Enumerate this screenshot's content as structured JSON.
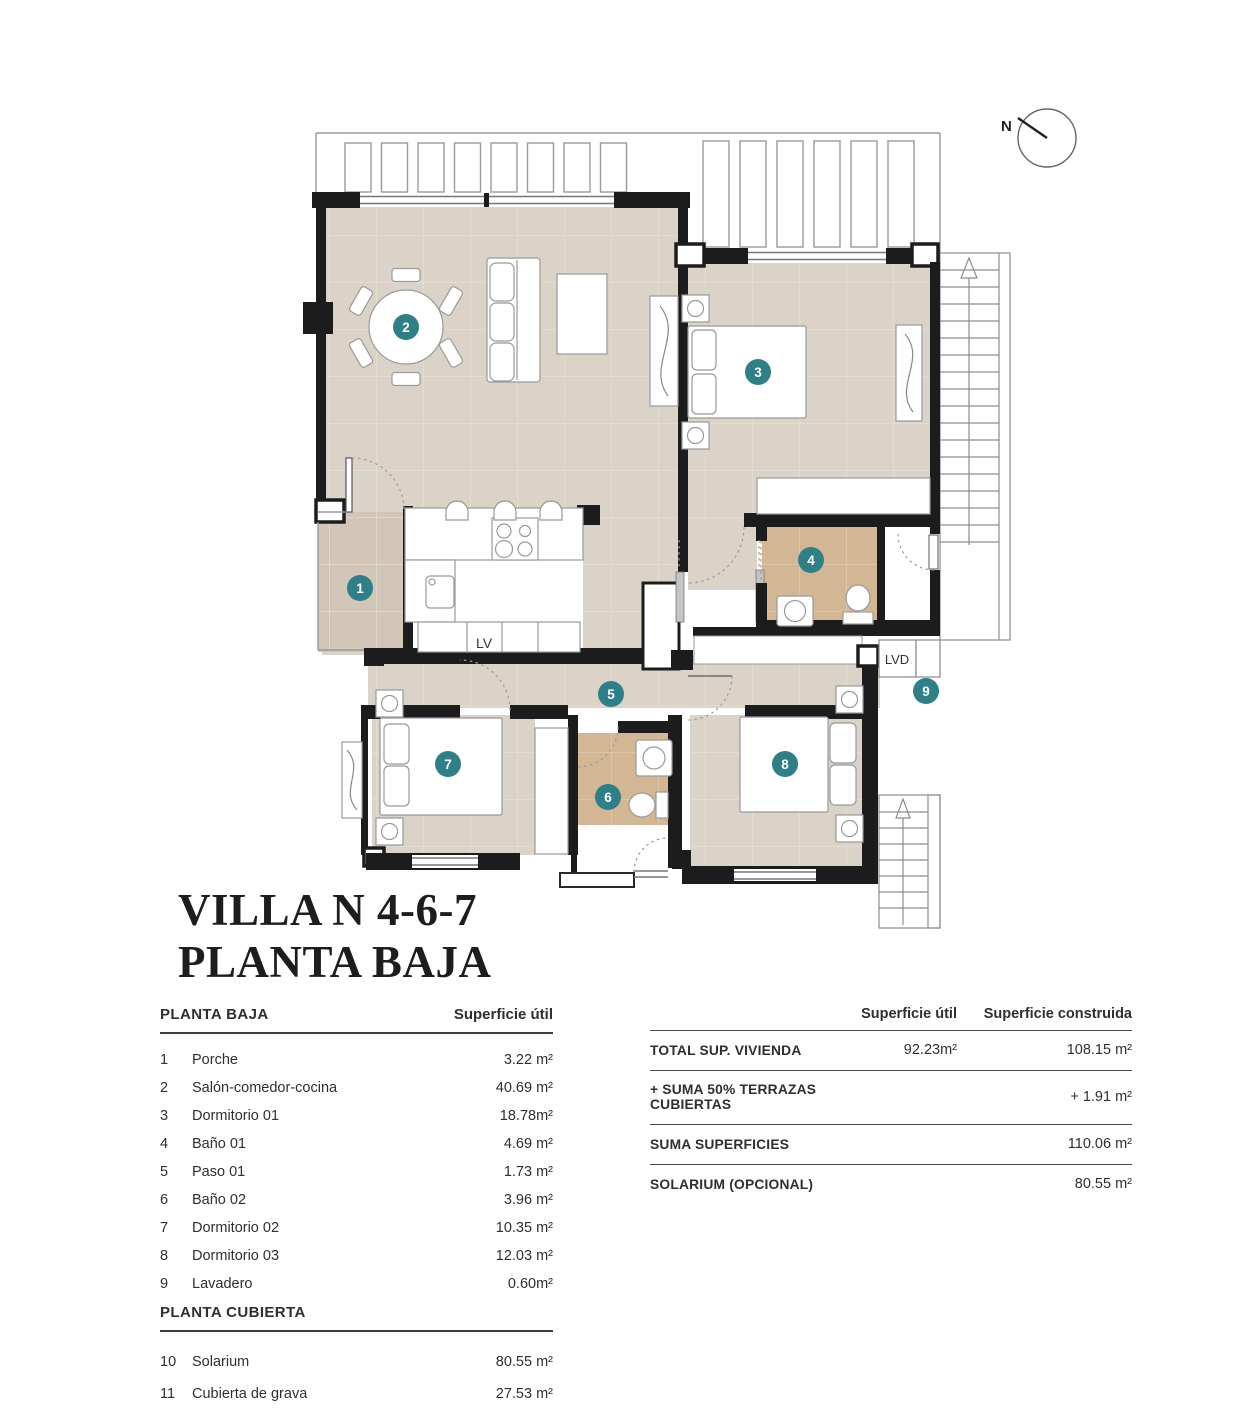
{
  "title": {
    "line1": "VILLA N 4-6-7",
    "line2": "PLANTA BAJA"
  },
  "compass": {
    "label": "N"
  },
  "plan_labels": {
    "dishwasher": "LV",
    "laundry_machine": "LVD"
  },
  "colors": {
    "floor": "#dbd3c8",
    "porch_floor": "#d1c6b7",
    "bath_floor": "#d3b794",
    "wall": "#1c1c1c",
    "marker": "#2f7f88",
    "marker_text": "#ffffff"
  },
  "rooms": [
    {
      "num": "1",
      "name": "Porche",
      "area": "3.22 m²"
    },
    {
      "num": "2",
      "name": "Salón-comedor-cocina",
      "area": "40.69 m²"
    },
    {
      "num": "3",
      "name": "Dormitorio 01",
      "area": "18.78m²"
    },
    {
      "num": "4",
      "name": "Baño 01",
      "area": "4.69 m²"
    },
    {
      "num": "5",
      "name": "Paso 01",
      "area": "1.73 m²"
    },
    {
      "num": "6",
      "name": "Baño 02",
      "area": "3.96 m²"
    },
    {
      "num": "7",
      "name": "Dormitorio 02",
      "area": "10.35 m²"
    },
    {
      "num": "8",
      "name": "Dormitorio 03",
      "area": "12.03 m²"
    },
    {
      "num": "9",
      "name": "Lavadero",
      "area": "0.60m²"
    }
  ],
  "left_table": {
    "section1": "PLANTA BAJA",
    "area_header": "Superficie útil",
    "section2": "PLANTA CUBIERTA",
    "cubierta_rows": [
      {
        "num": "10",
        "name": "Solarium",
        "area": "80.55 m²"
      },
      {
        "num": "11",
        "name": "Cubierta de grava",
        "area": "27.53 m²"
      }
    ]
  },
  "summary_table": {
    "col_util": "Superficie útil",
    "col_constr": "Superficie construida",
    "rows": [
      {
        "label": "TOTAL SUP. VIVIENDA",
        "util": "92.23m²",
        "constr": "108.15 m²",
        "ruled": true
      },
      {
        "label": "+ SUMA 50% TERRAZAS CUBIERTAS",
        "util": "",
        "constr": "+ 1.91 m²",
        "ruled": true
      },
      {
        "label": "SUMA SUPERFICIES",
        "util": "",
        "constr": "110.06 m²",
        "ruled": true
      },
      {
        "label": "SOLARIUM (OPCIONAL)",
        "util": "",
        "constr": "80.55 m²",
        "ruled": false
      }
    ]
  }
}
